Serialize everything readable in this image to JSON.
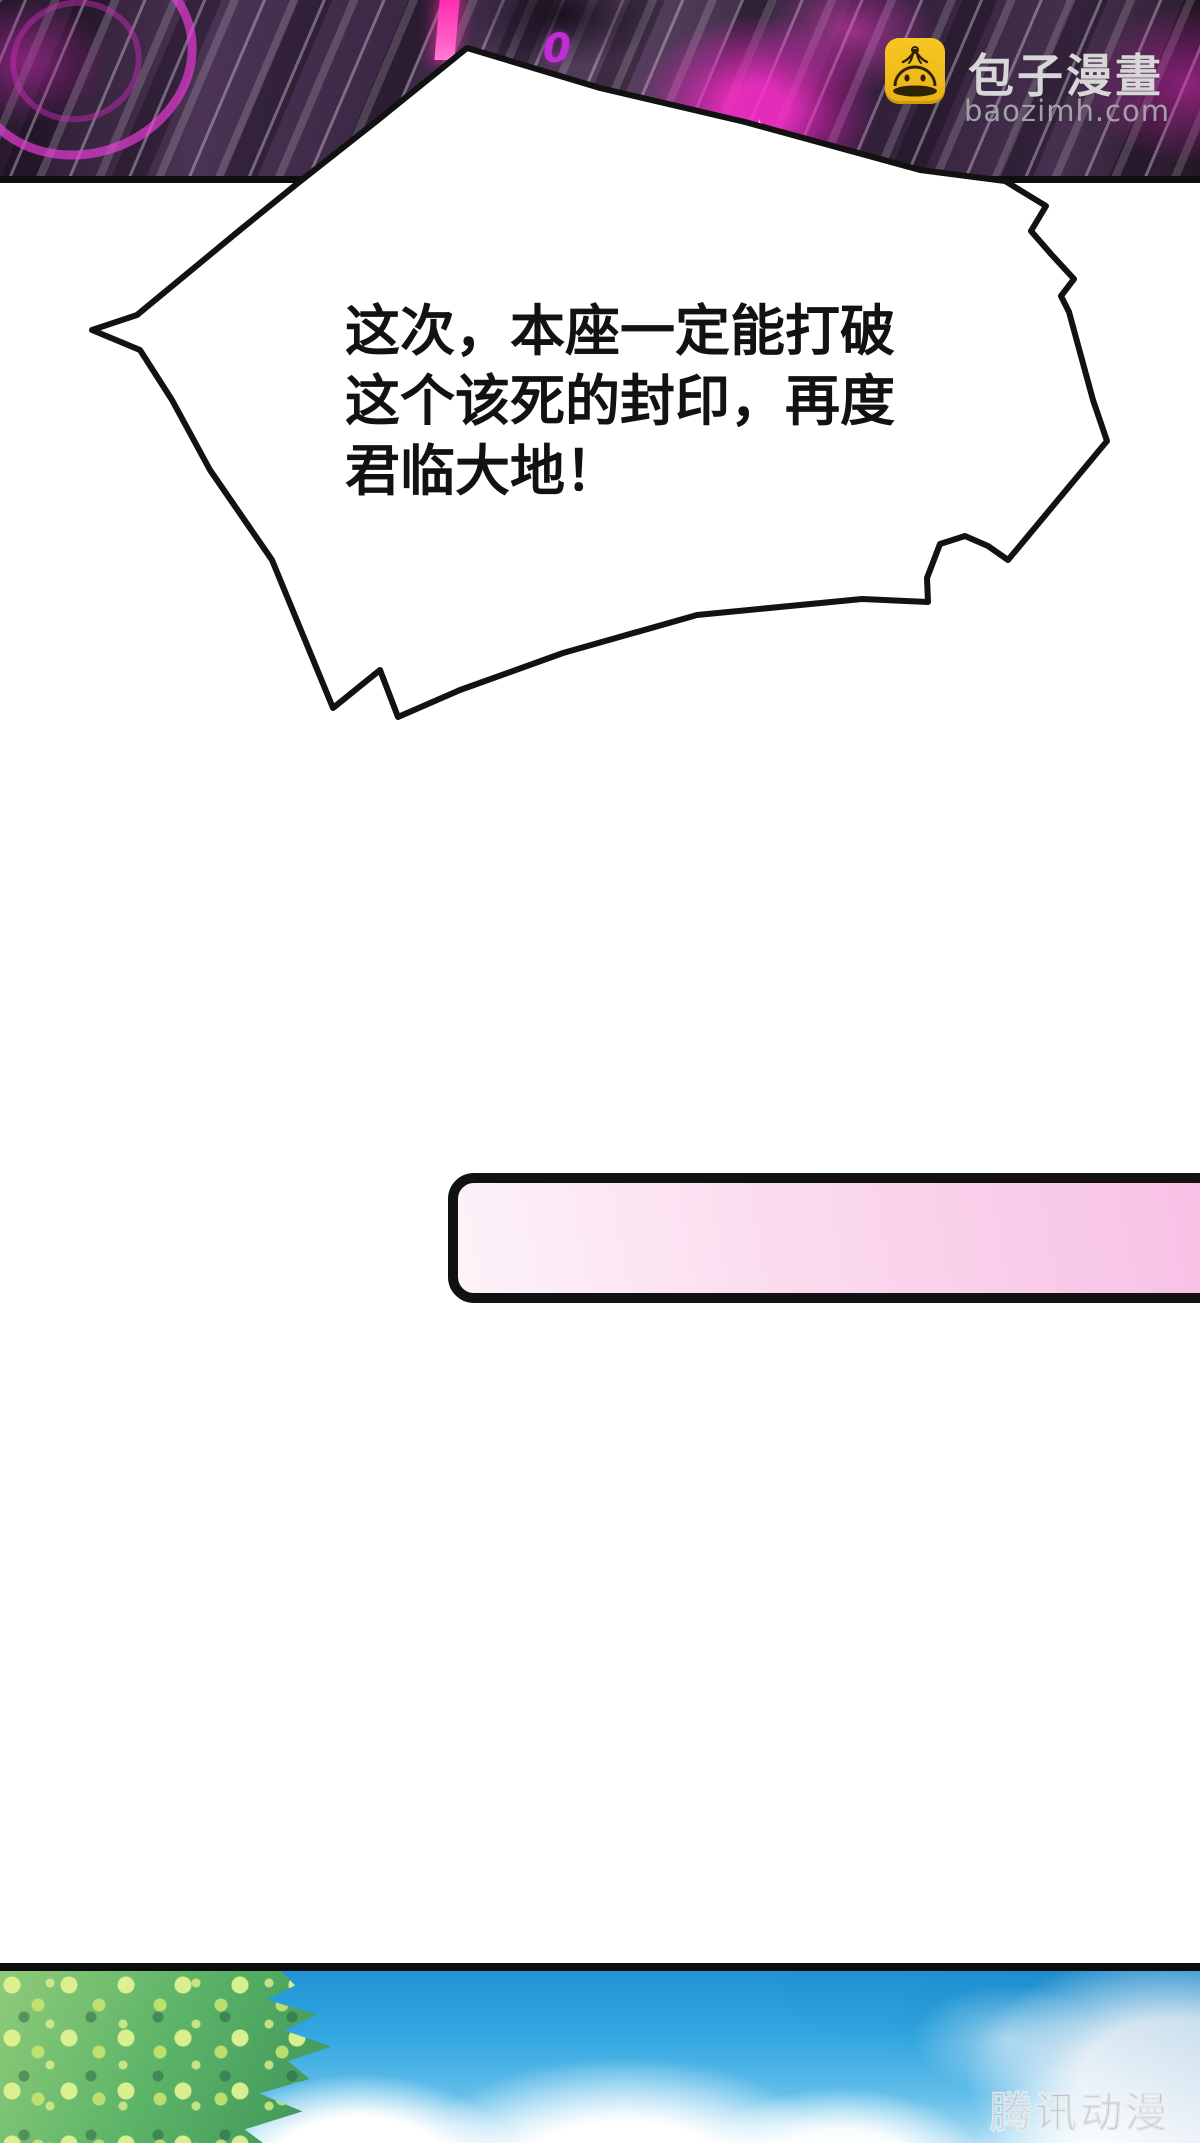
{
  "brand": {
    "name": "包子漫畫",
    "domain": "baozimh.com",
    "icon": "baozi-bun-icon",
    "icon_color": "#f3c01d",
    "name_color": "#d7d7d7",
    "domain_color": "#a2a2a6"
  },
  "bubble": {
    "line1": "这次，本座一定能打破",
    "line2": "这个该死的封印，再度",
    "line3": "君临大地！",
    "fill": "#ffffff",
    "stroke": "#121212"
  },
  "top_art": {
    "numeral": "0",
    "sparkle": "✦",
    "base_color": "#3f2b47",
    "glow_color": "#e838c8",
    "beam_color": "#ff2db0",
    "line_color": "#dfd6e7"
  },
  "banner": {
    "color_left": "#fdf3f9",
    "color_right": "#f7bfe4",
    "border_color": "#111111"
  },
  "scene": {
    "watermark": "腾讯动漫",
    "sky_color": "#31a6e0",
    "foliage_color": "#5cb468",
    "cloud_color": "#ffffff",
    "border_color": "#0c0c0c"
  }
}
